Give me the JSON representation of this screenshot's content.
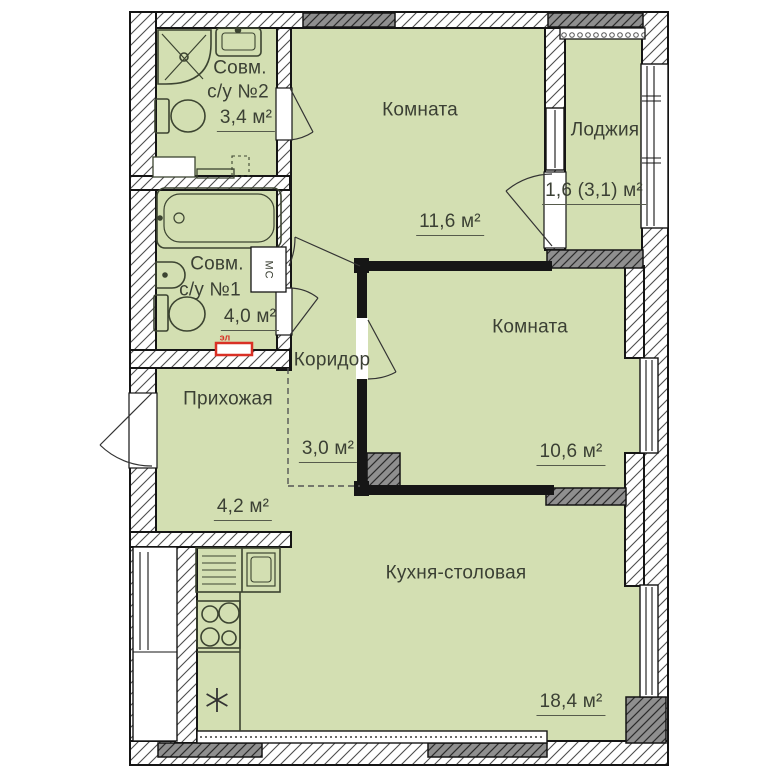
{
  "rooms": {
    "bath2": {
      "name_line1": "Совм.",
      "name_line2": "с/у №2",
      "area": "3,4 м²"
    },
    "room1": {
      "name": "Комната",
      "area": "11,6 м²"
    },
    "loggia": {
      "name": "Лоджия",
      "area": "1,6 (3,1) м²"
    },
    "bath1": {
      "name_line1": "Совм.",
      "name_line2": "с/у №1",
      "area": "4,0 м²"
    },
    "corridor": {
      "name": "Коридор",
      "area": "3,0 м²"
    },
    "room2": {
      "name": "Комната",
      "area": "10,6 м²"
    },
    "hallway": {
      "name": "Прихожая",
      "area": "4,2 м²"
    },
    "kitchen": {
      "name": "Кухня-столовая",
      "area": "18,4 м²"
    }
  },
  "markers": {
    "washing_machine": "МС",
    "electrical_panel": "эл"
  },
  "colors": {
    "room_fill": "#d3dfb2",
    "wall_hatch_bg": "#ffffff",
    "concrete_block": "#8f8f8f",
    "line": "#151515",
    "accent_red": "#d93025",
    "label_text": "#3b4034"
  }
}
